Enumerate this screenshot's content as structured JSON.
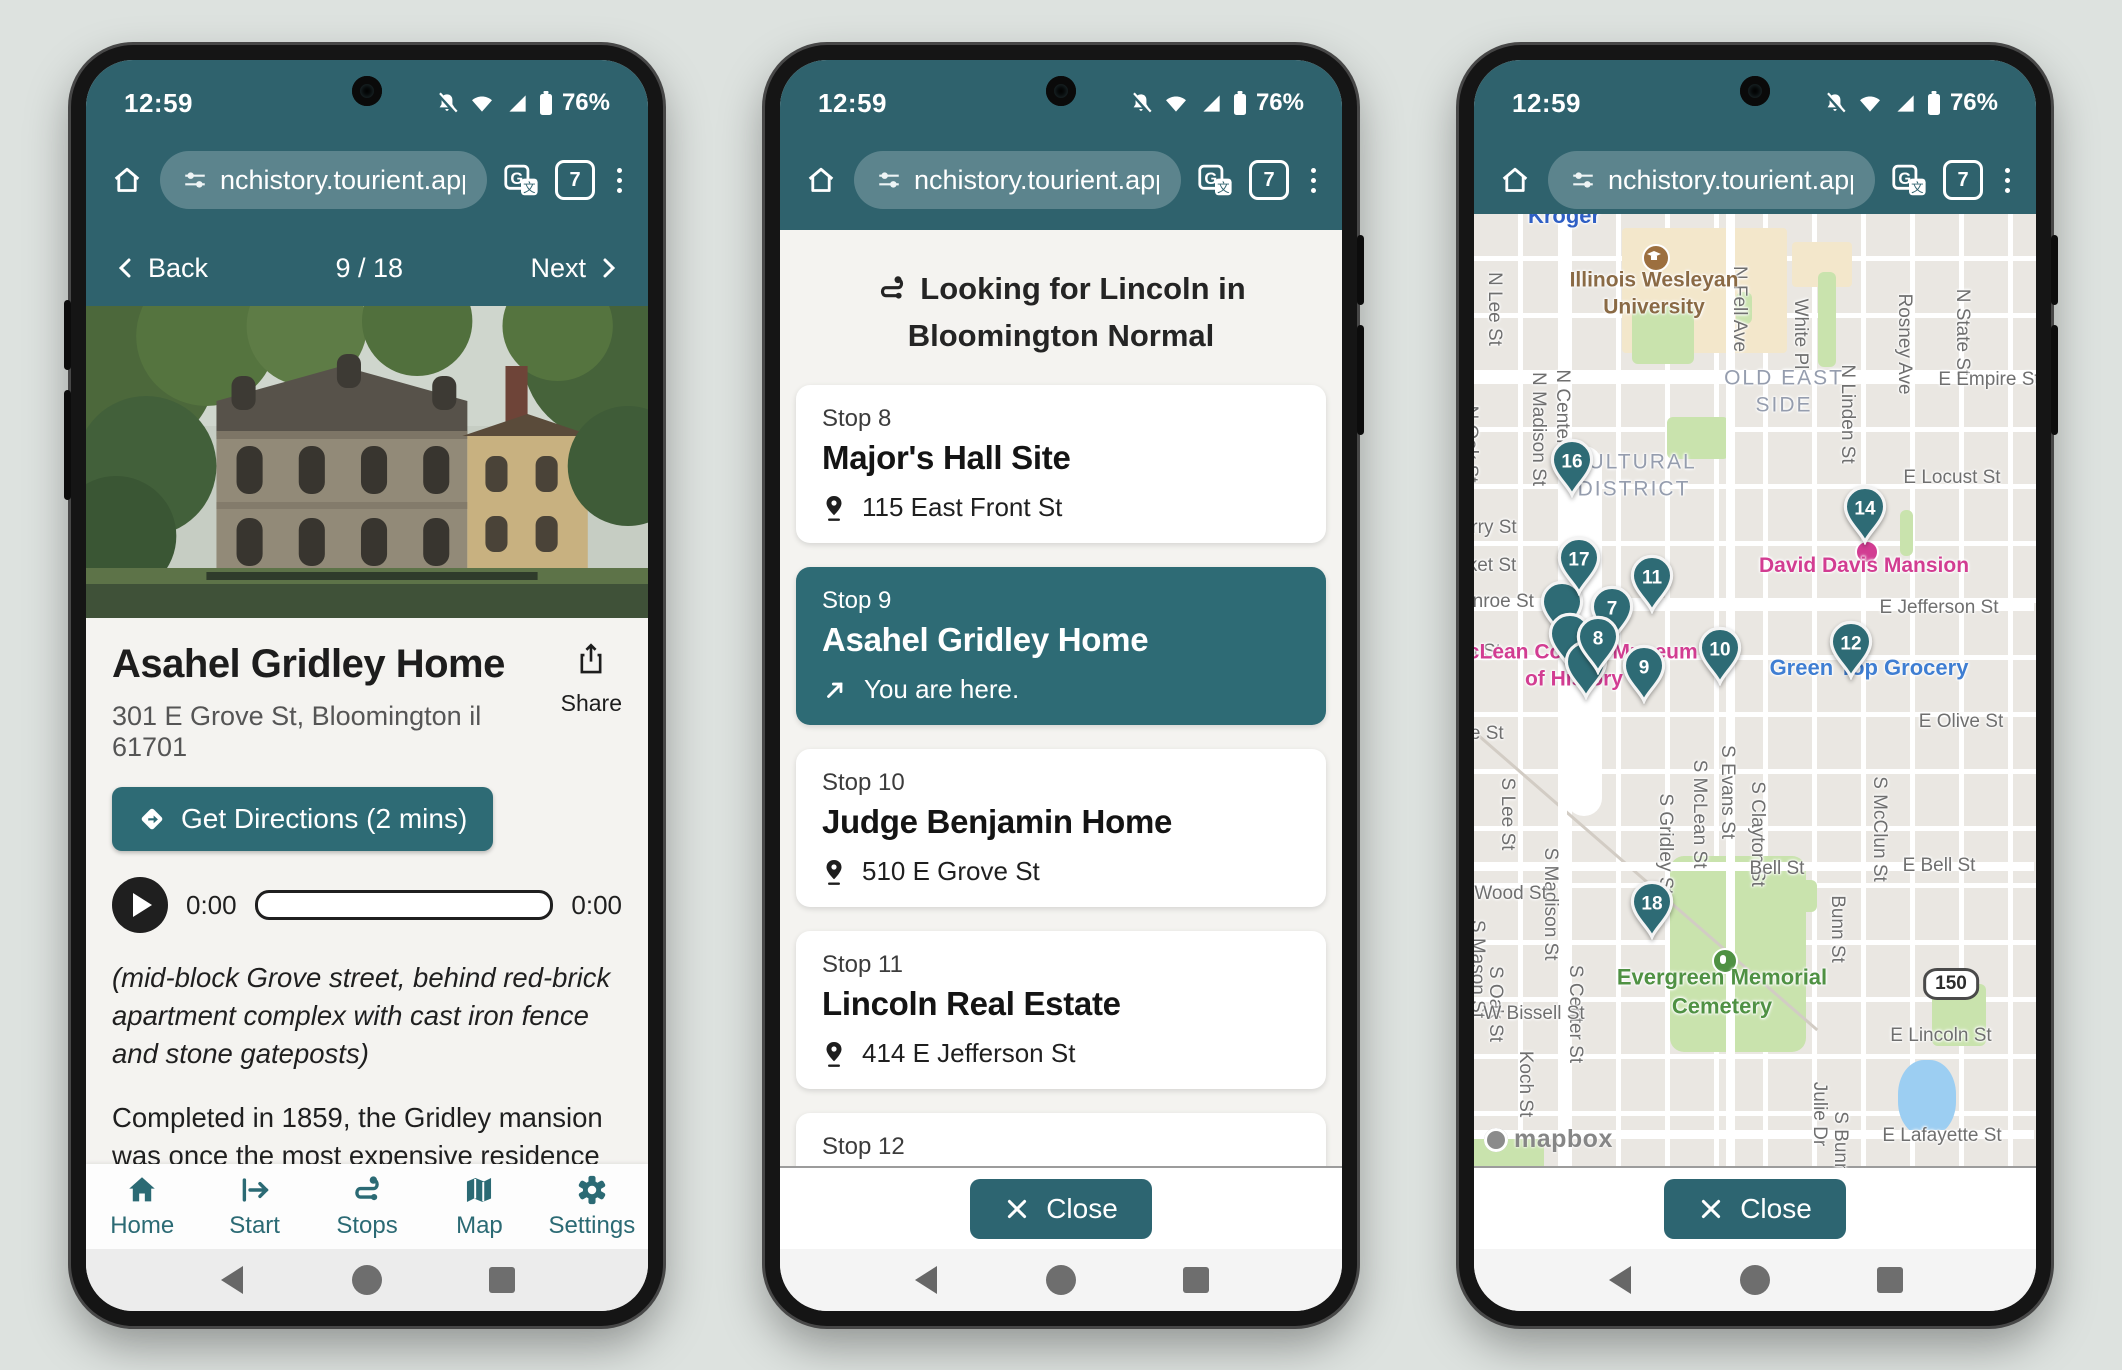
{
  "colors": {
    "chrome": "#2f626d",
    "accent": "#2e6b75",
    "nav_teal": "#2b6a74",
    "page_bg": "#dde2df"
  },
  "chrome": {
    "time": "12:59",
    "battery": "76%",
    "url": "nchistory.tourient.app",
    "tab_count": "7"
  },
  "phone1": {
    "nav": {
      "back": "Back",
      "position": "9 / 18",
      "next": "Next"
    },
    "title": "Asahel Gridley Home",
    "address": "301 E Grove St, Bloomington il 61701",
    "share_label": "Share",
    "directions_label": "Get Directions (2 mins)",
    "audio": {
      "current": "0:00",
      "total": "0:00"
    },
    "description_italic": "(mid-block Grove street, behind red-brick apartment complex with cast iron fence and stone gateposts)",
    "description": "Completed in 1859, the Gridley mansion was once the most expensive residence in Bloomington. In the mid 1930's, an apartment",
    "tabs": [
      {
        "label": "Home"
      },
      {
        "label": "Start"
      },
      {
        "label": "Stops"
      },
      {
        "label": "Map"
      },
      {
        "label": "Settings"
      }
    ]
  },
  "phone2": {
    "header": "Looking for Lincoln in Bloomington Normal",
    "stops": [
      {
        "stop": "Stop 8",
        "name": "Major's Hall Site",
        "address": "115 East Front St"
      },
      {
        "stop": "Stop 9",
        "name": "Asahel Gridley Home",
        "address": "You are here."
      },
      {
        "stop": "Stop 10",
        "name": "Judge Benjamin Home",
        "address": "510 E Grove St"
      },
      {
        "stop": "Stop 11",
        "name": "Lincoln Real Estate",
        "address": "414 E Jefferson St"
      },
      {
        "stop": "Stop 12",
        "name": "Illinois Central Railroad Site",
        "address": "916 E Grove St"
      }
    ],
    "close_label": "Close"
  },
  "phone3": {
    "close_label": "Close",
    "map": {
      "attribution": "mapbox",
      "pins": [
        {
          "n": "16",
          "x": 98,
          "y": 250
        },
        {
          "n": "",
          "x": 88,
          "y": 392
        },
        {
          "n": "",
          "x": 96,
          "y": 424
        },
        {
          "n": "",
          "x": 112,
          "y": 452
        },
        {
          "n": "7",
          "x": 138,
          "y": 397
        },
        {
          "n": "8",
          "x": 124,
          "y": 427
        },
        {
          "n": "17",
          "x": 105,
          "y": 348
        },
        {
          "n": "11",
          "x": 178,
          "y": 366
        },
        {
          "n": "9",
          "x": 170,
          "y": 456
        },
        {
          "n": "10",
          "x": 246,
          "y": 438
        },
        {
          "n": "12",
          "x": 377,
          "y": 432
        },
        {
          "n": "14",
          "x": 391,
          "y": 297
        },
        {
          "n": "18",
          "x": 178,
          "y": 692
        }
      ],
      "labels": [
        {
          "t": "N Lee St",
          "x": 20,
          "y": 95,
          "cls": "v"
        },
        {
          "t": "N Oak St",
          "x": -4,
          "y": 230,
          "cls": "v"
        },
        {
          "t": "N Madison St",
          "x": 64,
          "y": 215,
          "cls": "v"
        },
        {
          "t": "N Center St",
          "x": 88,
          "y": 205,
          "cls": "v"
        },
        {
          "t": "N Fell Ave",
          "x": 265,
          "y": 95,
          "cls": "v"
        },
        {
          "t": "White Pl",
          "x": 326,
          "y": 120,
          "cls": "v"
        },
        {
          "t": "N Linden St",
          "x": 373,
          "y": 200,
          "cls": "v"
        },
        {
          "t": "Rosney Ave",
          "x": 430,
          "y": 130,
          "cls": "v"
        },
        {
          "t": "N State St",
          "x": 488,
          "y": 118,
          "cls": "v"
        },
        {
          "t": "S Lee St",
          "x": 33,
          "y": 600,
          "cls": "v"
        },
        {
          "t": "S Madison St",
          "x": 76,
          "y": 690,
          "cls": "v"
        },
        {
          "t": "S Center St",
          "x": 101,
          "y": 800,
          "cls": "v"
        },
        {
          "t": "S Gridley St",
          "x": 191,
          "y": 630,
          "cls": "v"
        },
        {
          "t": "S McLean St",
          "x": 225,
          "y": 600,
          "cls": "v"
        },
        {
          "t": "S Evans St",
          "x": 253,
          "y": 578,
          "cls": "v"
        },
        {
          "t": "S Clayton St",
          "x": 283,
          "y": 620,
          "cls": "v"
        },
        {
          "t": "Bunn St",
          "x": 363,
          "y": 715,
          "cls": "v"
        },
        {
          "t": "S McClun St",
          "x": 405,
          "y": 615,
          "cls": "v"
        },
        {
          "t": "S Oak St",
          "x": 21,
          "y": 790,
          "cls": "v"
        },
        {
          "t": "S Mason St",
          "x": 3,
          "y": 755,
          "cls": "v"
        },
        {
          "t": "Koch St",
          "x": 51,
          "y": 870,
          "cls": "v"
        },
        {
          "t": "Julie Dr",
          "x": 345,
          "y": 900,
          "cls": "v"
        },
        {
          "t": "S Bunn St",
          "x": 366,
          "y": 940,
          "cls": "v"
        },
        {
          "t": "E Empire St",
          "x": 515,
          "y": 166,
          "cls": ""
        },
        {
          "t": "E Locust St",
          "x": 478,
          "y": 264,
          "cls": ""
        },
        {
          "t": "E Jefferson St",
          "x": 465,
          "y": 394,
          "cls": ""
        },
        {
          "t": "E Olive St",
          "x": 487,
          "y": 508,
          "cls": ""
        },
        {
          "t": "Bell St",
          "x": 303,
          "y": 655,
          "cls": ""
        },
        {
          "t": "E Bell St",
          "x": 465,
          "y": 652,
          "cls": ""
        },
        {
          "t": "W Wood St",
          "x": 25,
          "y": 680,
          "cls": ""
        },
        {
          "t": "W Bissell St",
          "x": 60,
          "y": 800,
          "cls": ""
        },
        {
          "t": "E Lincoln St",
          "x": 467,
          "y": 822,
          "cls": ""
        },
        {
          "t": "E Lafayette St",
          "x": 468,
          "y": 922,
          "cls": ""
        },
        {
          "t": "rry St",
          "x": 20,
          "y": 314,
          "cls": ""
        },
        {
          "t": "ket St",
          "x": 18,
          "y": 352,
          "cls": ""
        },
        {
          "t": "onroe St",
          "x": 24,
          "y": 388,
          "cls": ""
        },
        {
          "t": "n St",
          "x": 10,
          "y": 438,
          "cls": ""
        },
        {
          "t": "ve St",
          "x": 8,
          "y": 520,
          "cls": ""
        },
        {
          "t": "OLD EAST SIDE",
          "x": 310,
          "y": 178,
          "cls": "area wrap",
          "w": 140
        },
        {
          "t": "CULTURAL DISTRICT",
          "x": 160,
          "y": 262,
          "cls": "area wrap",
          "w": 170
        },
        {
          "t": "Kroger",
          "x": 90,
          "y": 2,
          "cls": "kroger"
        },
        {
          "t": "Illinois Wesleyan University",
          "x": 180,
          "y": 80,
          "cls": "brown wrap",
          "w": 220
        },
        {
          "t": "David Davis Mansion",
          "x": 390,
          "y": 352,
          "cls": "pink"
        },
        {
          "t": "McLean County Museum of History",
          "x": 100,
          "y": 452,
          "cls": "pink wrap",
          "w": 250
        },
        {
          "t": "Green Top Grocery",
          "x": 395,
          "y": 454,
          "cls": "blue"
        },
        {
          "t": "Evergreen Memorial Cemetery",
          "x": 248,
          "y": 778,
          "cls": "green wrap",
          "w": 230
        },
        {
          "t": "150",
          "x": 477,
          "y": 770,
          "cls": "shield"
        }
      ]
    }
  }
}
